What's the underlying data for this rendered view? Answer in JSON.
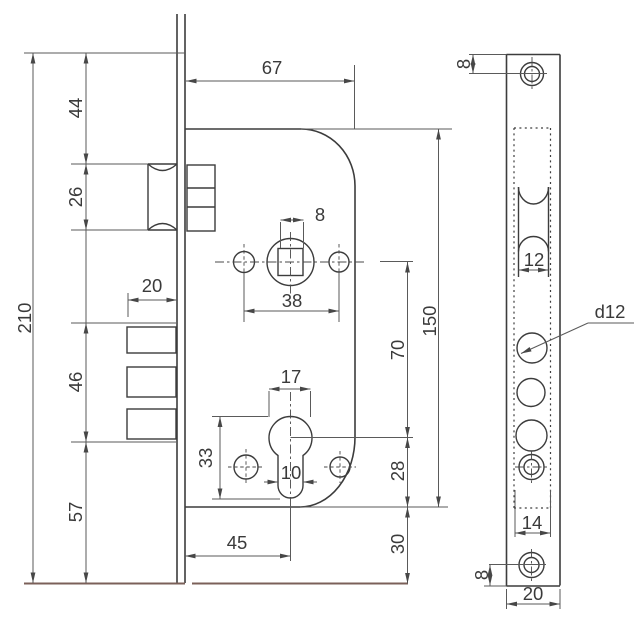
{
  "drawing": {
    "background": "#ffffff",
    "line_color": "#3c3c3c",
    "dim_color": "#5a5a5a",
    "accent_line_color": "#7b6059",
    "views": {
      "side_view": {
        "dims": {
          "body_width": "67",
          "top_to_latch": "44",
          "latch_height": "26",
          "total_height": "210",
          "deadbolt_throw": "20",
          "deadbolt_height": "46",
          "bottom_margin": "57",
          "spindle_square": "8",
          "hole_spacing": "38",
          "spindle_to_cylinder": "70",
          "body_height": "150",
          "cylinder_width": "17",
          "cylinder_height": "33",
          "cylinder_slot_width": "10",
          "cylinder_to_body_bottom": "28",
          "body_bottom_to_plate_end": "30",
          "backset": "45"
        }
      },
      "faceplate_view": {
        "dims": {
          "top_hole_offset": "8",
          "latch_cutout_width": "12",
          "hole_diameter_label": "d12",
          "cutout_width": "14",
          "bottom_hole_offset": "8",
          "plate_width": "20"
        }
      }
    }
  }
}
